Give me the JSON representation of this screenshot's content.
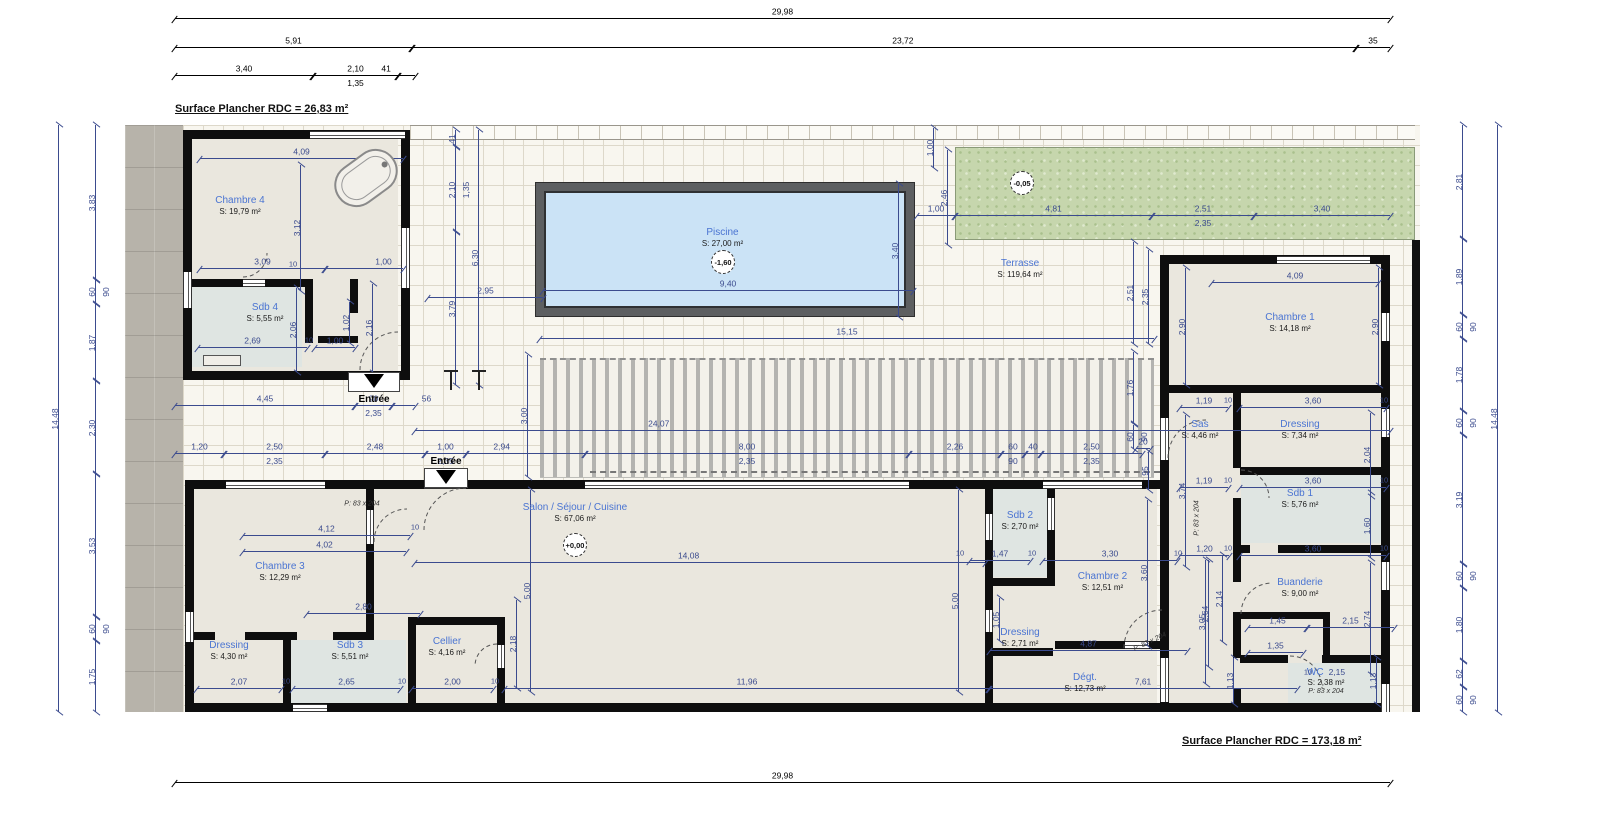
{
  "surfaces": {
    "top": "Surface Plancher RDC = 26,83 m²",
    "bottom": "Surface Plancher RDC = 173,18 m²"
  },
  "rooms": [
    {
      "id": "chambre4",
      "name": "Chambre 4",
      "area": "S: 19,79 m²",
      "x": 180,
      "y": 190,
      "w": 120,
      "h": 32
    },
    {
      "id": "sdb4",
      "name": "Sdb 4",
      "area": "S: 5,55 m²",
      "x": 205,
      "y": 298,
      "w": 120,
      "h": 30
    },
    {
      "id": "piscine",
      "name": "Piscine",
      "area": "S: 27,00 m²",
      "x": 660,
      "y": 220,
      "w": 125,
      "h": 36
    },
    {
      "id": "terrasse",
      "name": "Terrasse",
      "area": "S: 119,64 m²",
      "x": 960,
      "y": 254,
      "w": 120,
      "h": 30
    },
    {
      "id": "chambre1",
      "name": "Chambre 1",
      "area": "S: 14,18 m²",
      "x": 1230,
      "y": 306,
      "w": 120,
      "h": 34
    },
    {
      "id": "sas",
      "name": "Sas",
      "area": "S: 4,46 m²",
      "x": 1168,
      "y": 414,
      "w": 64,
      "h": 32
    },
    {
      "id": "dressing1",
      "name": "Dressing",
      "area": "S: 7,34 m²",
      "x": 1240,
      "y": 414,
      "w": 120,
      "h": 32
    },
    {
      "id": "sdb1",
      "name": "Sdb 1",
      "area": "S: 5,76 m²",
      "x": 1240,
      "y": 484,
      "w": 120,
      "h": 30
    },
    {
      "id": "buanderie",
      "name": "Buanderie",
      "area": "S: 9,00 m²",
      "x": 1240,
      "y": 572,
      "w": 120,
      "h": 32
    },
    {
      "id": "wc",
      "name": "WC",
      "d": "2,15",
      "area": "S: 2,38 m²",
      "tag": "P: 83 x 204",
      "x": 1272,
      "y": 661,
      "w": 108,
      "h": 40
    },
    {
      "id": "salon",
      "name": "Salon / Séjour / Cuisine",
      "area": "S: 67,06 m²",
      "x": 495,
      "y": 498,
      "w": 160,
      "h": 30
    },
    {
      "id": "chambre3",
      "name": "Chambre 3",
      "area": "S: 12,29 m²",
      "x": 230,
      "y": 556,
      "w": 100,
      "h": 32
    },
    {
      "id": "dressing3",
      "name": "Dressing",
      "area": "S: 4,30 m²",
      "x": 185,
      "y": 636,
      "w": 88,
      "h": 30
    },
    {
      "id": "sdb3",
      "name": "Sdb 3",
      "area": "S: 5,51 m²",
      "x": 295,
      "y": 636,
      "w": 110,
      "h": 30
    },
    {
      "id": "cellier",
      "name": "Cellier",
      "area": "S: 4,16 m²",
      "x": 404,
      "y": 632,
      "w": 86,
      "h": 30
    },
    {
      "id": "sdb2",
      "name": "Sdb 2",
      "area": "S: 2,70 m²",
      "x": 993,
      "y": 505,
      "w": 54,
      "h": 32
    },
    {
      "id": "chambre2",
      "name": "Chambre 2",
      "area": "S: 12,51 m²",
      "x": 1050,
      "y": 566,
      "w": 105,
      "h": 32
    },
    {
      "id": "dressing2",
      "name": "Dressing",
      "area": "S: 2,71 m²",
      "x": 985,
      "y": 622,
      "w": 70,
      "h": 32
    },
    {
      "id": "degt",
      "name": "Dégt.",
      "area": "S: 12,73 m²",
      "x": 1040,
      "y": 668,
      "w": 90,
      "h": 30
    }
  ],
  "markers": [
    {
      "t": "-1,60",
      "x": 711,
      "y": 250
    },
    {
      "t": "-0,05",
      "x": 1010,
      "y": 171
    },
    {
      "t": "+0,00",
      "x": 563,
      "y": 533
    }
  ],
  "entrances": [
    {
      "t": "Entrée",
      "px": 348,
      "py": 372,
      "pw": 52,
      "ph": 20,
      "ax": 374,
      "ay": 374,
      "lx": 374,
      "ly": 394
    },
    {
      "t": "Entrée",
      "px": 424,
      "py": 468,
      "pw": 44,
      "ph": 20,
      "ax": 446,
      "ay": 470,
      "lx": 446,
      "ly": 456
    }
  ],
  "texts": [
    [
      415,
      527,
      "10"
    ],
    [
      286,
      681,
      "10"
    ],
    [
      402,
      681,
      "10"
    ],
    [
      495,
      681,
      "10"
    ],
    [
      960,
      553,
      "10"
    ],
    [
      1032,
      553,
      "10"
    ],
    [
      1178,
      553,
      "10"
    ],
    [
      1228,
      400,
      "10"
    ],
    [
      1384,
      400,
      "10"
    ],
    [
      1228,
      480,
      "10"
    ],
    [
      1384,
      480,
      "10"
    ],
    [
      1228,
      548,
      "10"
    ],
    [
      1384,
      548,
      "10"
    ],
    [
      293,
      264,
      "10"
    ],
    [
      309,
      340,
      "10"
    ],
    [
      1308,
      672,
      "10"
    ],
    [
      362,
      504,
      "P: 83 x 204",
      0,
      "tag"
    ],
    [
      1197,
      518,
      "P: 83 x 204",
      -90,
      "tag"
    ],
    [
      1150,
      642,
      "P: 83 x 204",
      -25,
      "tag"
    ]
  ],
  "dims": [
    [
      "h",
      175,
      18,
      1215,
      "29,98",
      null,
      0.5,
      "k"
    ],
    [
      "h",
      175,
      47,
      237,
      "5,91",
      null,
      0.5,
      "k"
    ],
    [
      "h",
      412,
      47,
      944,
      "23,72",
      null,
      0.52,
      "k"
    ],
    [
      "h",
      1356,
      47,
      34,
      "35",
      null,
      0.5,
      "k"
    ],
    [
      "h",
      175,
      75,
      138,
      "3,40",
      null,
      0.5,
      "k"
    ],
    [
      "h",
      313,
      75,
      85,
      "2,10",
      "1,35",
      0.5,
      "k"
    ],
    [
      "h",
      398,
      75,
      17,
      "41",
      null,
      -0.7,
      "k"
    ],
    [
      "h",
      175,
      782,
      1215,
      "29,98",
      null,
      0.5,
      "k"
    ],
    [
      "v",
      58,
      125,
      587,
      "14,48"
    ],
    [
      "v",
      95,
      125,
      155,
      "3,83"
    ],
    [
      "v",
      95,
      280,
      24,
      "60",
      "90"
    ],
    [
      "v",
      95,
      304,
      77,
      "1,87"
    ],
    [
      "v",
      95,
      381,
      93,
      "2,30"
    ],
    [
      "v",
      95,
      474,
      143,
      "3,53"
    ],
    [
      "v",
      95,
      617,
      24,
      "60",
      "90"
    ],
    [
      "v",
      95,
      641,
      71,
      "1,75"
    ],
    [
      "v",
      1497,
      125,
      587,
      "14,48"
    ],
    [
      "v",
      1462,
      125,
      114,
      "2,81"
    ],
    [
      "v",
      1462,
      239,
      76,
      "1,89"
    ],
    [
      "v",
      1462,
      315,
      24,
      "60",
      "90"
    ],
    [
      "v",
      1462,
      339,
      72,
      "1,78"
    ],
    [
      "v",
      1462,
      411,
      24,
      "60",
      "90"
    ],
    [
      "v",
      1462,
      435,
      129,
      "3,19"
    ],
    [
      "v",
      1462,
      564,
      24,
      "60",
      "90"
    ],
    [
      "v",
      1462,
      588,
      73,
      "1,80"
    ],
    [
      "v",
      1462,
      661,
      26,
      "62"
    ],
    [
      "v",
      1462,
      687,
      25,
      "60",
      "90"
    ],
    [
      "h",
      543,
      290,
      370,
      "9,40"
    ],
    [
      "v",
      898,
      184,
      133,
      "3,40"
    ],
    [
      "v",
      933,
      128,
      40,
      "1,00"
    ],
    [
      "h",
      917,
      215,
      38,
      "1,00"
    ],
    [
      "h",
      955,
      215,
      197,
      "4,81"
    ],
    [
      "h",
      1152,
      215,
      102,
      "2,51",
      "2,35"
    ],
    [
      "h",
      1254,
      215,
      136,
      "3,40"
    ],
    [
      "v",
      947,
      150,
      95,
      "2,46"
    ],
    [
      "v",
      1133,
      242,
      102,
      "2,51"
    ],
    [
      "v",
      1148,
      250,
      94,
      "2,35"
    ],
    [
      "v",
      1133,
      352,
      71,
      "1,76"
    ],
    [
      "v",
      1133,
      425,
      24,
      "60",
      "90"
    ],
    [
      "v",
      1148,
      452,
      38,
      "95"
    ],
    [
      "h",
      1136,
      448,
      14,
      "20"
    ],
    [
      "v",
      455,
      130,
      17,
      "41"
    ],
    [
      "v",
      455,
      147,
      85,
      "2,10",
      "1,35"
    ],
    [
      "v",
      455,
      232,
      153,
      "3,79"
    ],
    [
      "v",
      478,
      130,
      255,
      "6,30"
    ],
    [
      "h",
      428,
      297,
      115,
      "2,95"
    ],
    [
      "h",
      540,
      338,
      614,
      "15,15"
    ],
    [
      "h",
      415,
      430,
      975,
      "24,07",
      null,
      0.25
    ],
    [
      "h",
      175,
      405,
      180,
      "4,45"
    ],
    [
      "h",
      355,
      405,
      37,
      "90",
      "2,35"
    ],
    [
      "h",
      392,
      405,
      23,
      "56",
      null,
      1.5
    ],
    [
      "v",
      527,
      355,
      122,
      "3,00"
    ],
    [
      "h",
      175,
      453,
      49,
      "1,20"
    ],
    [
      "h",
      224,
      453,
      101,
      "2,50",
      "2,35"
    ],
    [
      "h",
      325,
      453,
      100,
      "2,48"
    ],
    [
      "h",
      425,
      453,
      41,
      "1,00",
      "2,35"
    ],
    [
      "h",
      466,
      453,
      119,
      "2,94",
      null,
      0.3
    ],
    [
      "h",
      585,
      453,
      324,
      "8,00",
      "2,35"
    ],
    [
      "h",
      909,
      453,
      92,
      "2,26"
    ],
    [
      "h",
      1001,
      453,
      24,
      "60",
      "90"
    ],
    [
      "h",
      1025,
      453,
      16,
      "40"
    ],
    [
      "h",
      1041,
      453,
      101,
      "2,50",
      "2,35"
    ],
    [
      "h",
      200,
      158,
      203,
      "4,09"
    ],
    [
      "v",
      300,
      165,
      126,
      "3,12"
    ],
    [
      "h",
      200,
      268,
      125,
      "3,09"
    ],
    [
      "h",
      325,
      268,
      78,
      "1,00",
      null,
      0.75
    ],
    [
      "h",
      198,
      347,
      109,
      "2,69"
    ],
    [
      "h",
      315,
      347,
      40,
      "1,00"
    ],
    [
      "v",
      296,
      288,
      84,
      "2,06"
    ],
    [
      "v",
      349,
      302,
      41,
      "1,02"
    ],
    [
      "v",
      372,
      284,
      88,
      "2,16"
    ],
    [
      "h",
      1212,
      282,
      166,
      "4,09"
    ],
    [
      "v",
      1185,
      268,
      117,
      "2,90"
    ],
    [
      "v",
      1378,
      268,
      117,
      "2,90"
    ],
    [
      "h",
      1180,
      407,
      48,
      "1,19"
    ],
    [
      "h",
      1240,
      407,
      146,
      "3,60"
    ],
    [
      "v",
      1185,
      415,
      152,
      "3,74"
    ],
    [
      "v",
      1370,
      413,
      83,
      "2,04"
    ],
    [
      "h",
      1180,
      487,
      48,
      "1,19"
    ],
    [
      "h",
      1240,
      487,
      146,
      "3,60"
    ],
    [
      "v",
      1370,
      493,
      65,
      "1,60"
    ],
    [
      "h",
      1180,
      555,
      49,
      "1,20"
    ],
    [
      "h",
      1240,
      555,
      146,
      "3,60"
    ],
    [
      "v",
      1370,
      563,
      111,
      "2,74"
    ],
    [
      "v",
      1208,
      560,
      107,
      "2,64"
    ],
    [
      "v",
      1222,
      555,
      87,
      "2,14"
    ],
    [
      "h",
      1248,
      627,
      59,
      "1,45"
    ],
    [
      "h",
      1307,
      627,
      87,
      "2,15"
    ],
    [
      "h",
      1248,
      652,
      55,
      "1,35"
    ],
    [
      "v",
      1233,
      658,
      46,
      "1,13"
    ],
    [
      "v",
      1376,
      658,
      46,
      "1,13"
    ],
    [
      "v",
      1205,
      560,
      124,
      "3,05"
    ],
    [
      "h",
      243,
      535,
      167,
      "4,12"
    ],
    [
      "h",
      243,
      551,
      163,
      "4,02"
    ],
    [
      "h",
      307,
      613,
      113,
      "2,80"
    ],
    [
      "h",
      415,
      562,
      570,
      "14,08",
      null,
      0.48
    ],
    [
      "v",
      530,
      490,
      202,
      "5,00"
    ],
    [
      "v",
      516,
      600,
      88,
      "2,18"
    ],
    [
      "h",
      197,
      688,
      84,
      "2,07"
    ],
    [
      "h",
      293,
      688,
      107,
      "2,65"
    ],
    [
      "h",
      412,
      688,
      81,
      "2,00"
    ],
    [
      "h",
      505,
      688,
      484,
      "11,96"
    ],
    [
      "h",
      989,
      688,
      308,
      "7,61"
    ],
    [
      "h",
      970,
      560,
      60,
      "1,47"
    ],
    [
      "h",
      1043,
      560,
      134,
      "3,30"
    ],
    [
      "v",
      958,
      490,
      202,
      "5,00",
      null,
      0.55
    ],
    [
      "v",
      999,
      598,
      43,
      "1,05"
    ],
    [
      "h",
      990,
      650,
      197,
      "4,87"
    ],
    [
      "v",
      1147,
      500,
      146,
      "3,60"
    ]
  ],
  "geometry": {
    "fills": [
      [
        192,
        139,
        206,
        232,
        "b"
      ],
      [
        192,
        287,
        110,
        80,
        "s"
      ],
      [
        194,
        489,
        963,
        214,
        "b"
      ],
      [
        291,
        640,
        115,
        63,
        "s"
      ],
      [
        993,
        489,
        54,
        88,
        "s"
      ],
      [
        1169,
        264,
        212,
        439,
        "b"
      ],
      [
        1241,
        475,
        140,
        68,
        "s"
      ],
      [
        1288,
        663,
        92,
        40,
        "s"
      ]
    ],
    "walls": [
      [
        183,
        130,
        227,
        9
      ],
      [
        183,
        130,
        9,
        250
      ],
      [
        401,
        130,
        9,
        250
      ],
      [
        183,
        371,
        227,
        9
      ],
      [
        183,
        279,
        60,
        8
      ],
      [
        265,
        279,
        48,
        8
      ],
      [
        305,
        283,
        8,
        60
      ],
      [
        350,
        279,
        8,
        34
      ],
      [
        318,
        336,
        40,
        7
      ],
      [
        185,
        480,
        980,
        9
      ],
      [
        185,
        480,
        9,
        232
      ],
      [
        185,
        703,
        980,
        9
      ],
      [
        366,
        488,
        8,
        22
      ],
      [
        366,
        544,
        8,
        96
      ],
      [
        185,
        632,
        30,
        8
      ],
      [
        245,
        632,
        52,
        8
      ],
      [
        333,
        632,
        41,
        8
      ],
      [
        283,
        640,
        8,
        72
      ],
      [
        408,
        617,
        97,
        8
      ],
      [
        408,
        625,
        8,
        87
      ],
      [
        497,
        625,
        8,
        20
      ],
      [
        497,
        668,
        8,
        44
      ],
      [
        985,
        488,
        8,
        26
      ],
      [
        985,
        540,
        8,
        70
      ],
      [
        985,
        632,
        8,
        80
      ],
      [
        993,
        578,
        60,
        8
      ],
      [
        1047,
        488,
        8,
        10
      ],
      [
        1047,
        530,
        8,
        56
      ],
      [
        993,
        648,
        60,
        8
      ],
      [
        1055,
        641,
        70,
        8
      ],
      [
        1149,
        641,
        16,
        8
      ],
      [
        1160,
        255,
        9,
        457
      ],
      [
        1168,
        255,
        222,
        9
      ],
      [
        1381,
        255,
        9,
        457
      ],
      [
        1168,
        703,
        222,
        9
      ],
      [
        1168,
        385,
        213,
        8
      ],
      [
        1233,
        393,
        8,
        75
      ],
      [
        1233,
        498,
        8,
        84
      ],
      [
        1233,
        616,
        8,
        42
      ],
      [
        1233,
        688,
        8,
        24
      ],
      [
        1240,
        467,
        141,
        8
      ],
      [
        1240,
        545,
        10,
        8
      ],
      [
        1278,
        545,
        103,
        8
      ],
      [
        1233,
        612,
        97,
        7
      ],
      [
        1323,
        612,
        7,
        45
      ],
      [
        1240,
        655,
        48,
        8
      ],
      [
        1322,
        655,
        59,
        8
      ]
    ],
    "windows": [
      [
        310,
        131,
        95,
        8,
        "h"
      ],
      [
        183,
        272,
        9,
        36,
        "v"
      ],
      [
        401,
        228,
        9,
        60,
        "v"
      ],
      [
        352,
        372,
        46,
        8,
        "h"
      ],
      [
        243,
        279,
        22,
        8,
        "h"
      ],
      [
        226,
        481,
        99,
        8,
        "h"
      ],
      [
        585,
        481,
        324,
        8,
        "h"
      ],
      [
        1043,
        481,
        99,
        8,
        "h"
      ],
      [
        424,
        481,
        42,
        8,
        "h"
      ],
      [
        185,
        612,
        9,
        30,
        "v"
      ],
      [
        293,
        704,
        34,
        8,
        "h"
      ],
      [
        366,
        510,
        8,
        34,
        "v"
      ],
      [
        497,
        645,
        8,
        23,
        "v"
      ],
      [
        1047,
        498,
        8,
        32,
        "v"
      ],
      [
        985,
        514,
        8,
        26,
        "v"
      ],
      [
        985,
        610,
        8,
        22,
        "v"
      ],
      [
        1125,
        641,
        24,
        8,
        "h"
      ],
      [
        1277,
        256,
        93,
        8,
        "h"
      ],
      [
        1381,
        313,
        9,
        28,
        "v"
      ],
      [
        1381,
        409,
        9,
        28,
        "v"
      ],
      [
        1381,
        562,
        9,
        28,
        "v"
      ],
      [
        1381,
        684,
        9,
        28,
        "v"
      ],
      [
        1160,
        418,
        9,
        42,
        "v"
      ],
      [
        1160,
        658,
        9,
        44,
        "v"
      ]
    ],
    "arcs": [
      "M 360 370 A 38 38 0 0 1 398 332",
      "M 424 530 A 42 42 0 0 1 466 488",
      "M 374 542 A 33 33 0 0 1 407 509",
      "M 1124 648 A 38 38 0 0 1 1162 610",
      "M 1290 656 A 32 32 0 0 1 1322 688",
      "M 1168 458 A 38 38 0 0 1 1206 420",
      "M 1241 470 A 28 28 0 0 1 1269 498",
      "M 1241 614 A 31 31 0 0 1 1272 583",
      "M 243 277 A 24 24 0 0 0 267 253",
      "M 497 644 A 22 22 0 0 0 475 666"
    ],
    "trees": [
      [
        450,
        370
      ],
      [
        478,
        370
      ]
    ]
  }
}
